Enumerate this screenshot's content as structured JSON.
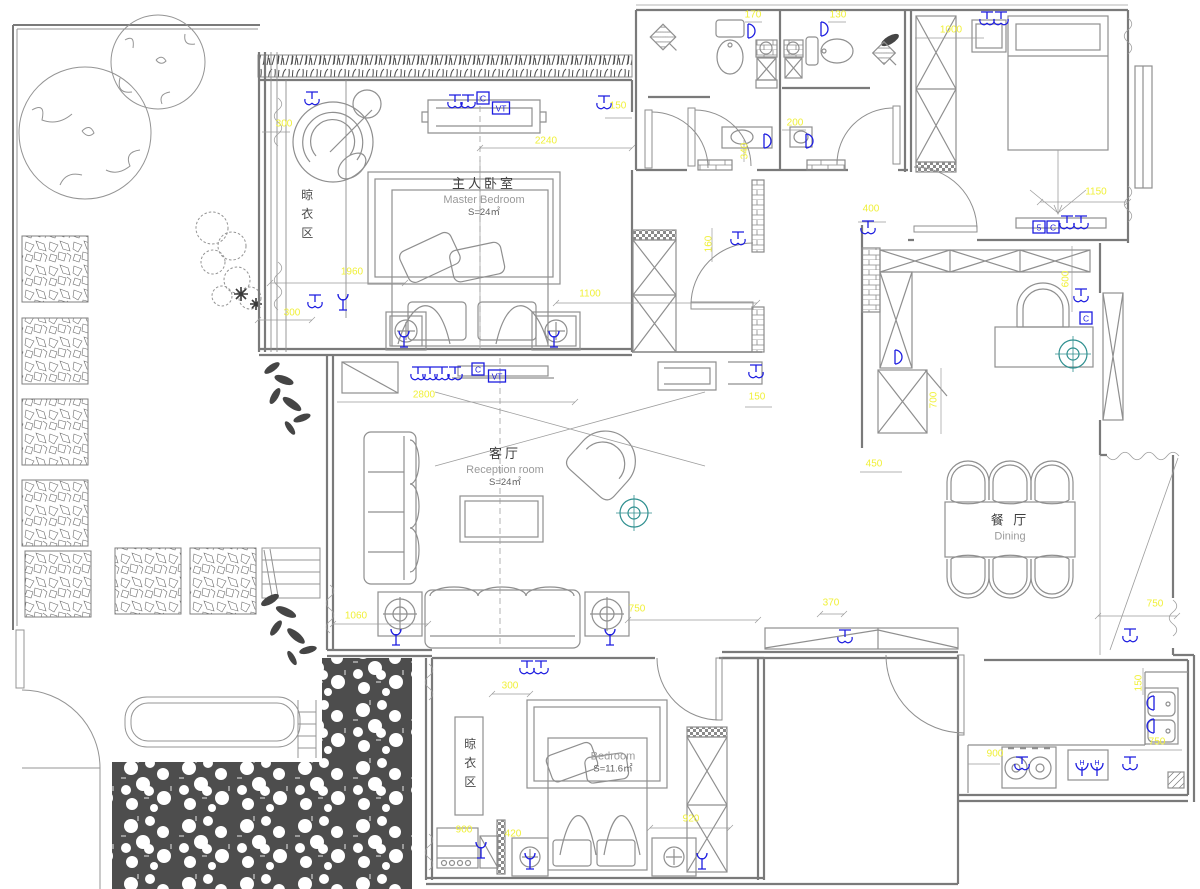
{
  "drawing": {
    "type": "residential floor plan (electrical / furniture layout)",
    "bg": "#ffffff",
    "colors": {
      "walls": "#7a7a7a",
      "furniture": "#8f8f8f",
      "dimension_text": "#f0f038",
      "electrical": "#1d1de0",
      "compass": "#2e8f8f",
      "foliage": "#454545"
    }
  },
  "rooms": [
    {
      "key": "master_bedroom",
      "name_zh": "主人卧室",
      "name_en": "Master Bedroom",
      "area": "S=24㎡"
    },
    {
      "key": "reception_room",
      "name_zh": "客厅",
      "name_en": "Reception  room",
      "area": "S=24㎡"
    },
    {
      "key": "dining_room",
      "name_zh": "餐 厅",
      "name_en": "Dining",
      "area": ""
    },
    {
      "key": "second_bedroom",
      "name_zh": "",
      "name_en": "Bedroom",
      "area": "S=11.6㎡"
    },
    {
      "key": "drying_area_north",
      "name_zh": "晾衣区",
      "name_en": "",
      "area": ""
    },
    {
      "key": "drying_area_south",
      "name_zh": "晾衣区",
      "name_en": "",
      "area": ""
    }
  ],
  "dimensions": [
    {
      "v": "300",
      "x": 284,
      "y": 124
    },
    {
      "v": "1960",
      "x": 352,
      "y": 272
    },
    {
      "v": "300",
      "x": 292,
      "y": 313
    },
    {
      "v": "2240",
      "x": 546,
      "y": 141
    },
    {
      "v": "150",
      "x": 618,
      "y": 106
    },
    {
      "v": "1100",
      "x": 590,
      "y": 294
    },
    {
      "v": "170",
      "x": 753,
      "y": 15
    },
    {
      "v": "130",
      "x": 838,
      "y": 15
    },
    {
      "v": "200",
      "x": 795,
      "y": 123
    },
    {
      "v": "340",
      "x": 745,
      "y": 151,
      "rot": 1
    },
    {
      "v": "1000",
      "x": 951,
      "y": 30
    },
    {
      "v": "1150",
      "x": 1096,
      "y": 192
    },
    {
      "v": "400",
      "x": 871,
      "y": 209
    },
    {
      "v": "160",
      "x": 709,
      "y": 244,
      "rot": 1
    },
    {
      "v": "150",
      "x": 757,
      "y": 397
    },
    {
      "v": "2800",
      "x": 424,
      "y": 395
    },
    {
      "v": "600",
      "x": 1066,
      "y": 279,
      "rot": 1
    },
    {
      "v": "700",
      "x": 934,
      "y": 400,
      "rot": 1
    },
    {
      "v": "450",
      "x": 874,
      "y": 464
    },
    {
      "v": "750",
      "x": 637,
      "y": 609
    },
    {
      "v": "1060",
      "x": 356,
      "y": 616
    },
    {
      "v": "750",
      "x": 1155,
      "y": 604
    },
    {
      "v": "370",
      "x": 831,
      "y": 603
    },
    {
      "v": "300",
      "x": 510,
      "y": 686
    },
    {
      "v": "900",
      "x": 464,
      "y": 830
    },
    {
      "v": "420",
      "x": 513,
      "y": 834
    },
    {
      "v": "920",
      "x": 691,
      "y": 819
    },
    {
      "v": "900",
      "x": 995,
      "y": 754
    },
    {
      "v": "750",
      "x": 1157,
      "y": 742
    },
    {
      "v": "150",
      "x": 1139,
      "y": 683,
      "rot": 1
    }
  ],
  "electrical": [
    {
      "type": "socket",
      "x": 312,
      "y": 100
    },
    {
      "type": "socket",
      "x": 455,
      "y": 103
    },
    {
      "type": "socket",
      "x": 468,
      "y": 103
    },
    {
      "type": "box",
      "label": "C",
      "x": 483,
      "y": 98
    },
    {
      "type": "box",
      "label": "VT",
      "x": 501,
      "y": 108
    },
    {
      "type": "socket",
      "x": 604,
      "y": 104
    },
    {
      "type": "socket",
      "x": 315,
      "y": 303
    },
    {
      "type": "lamp",
      "x": 343,
      "y": 303
    },
    {
      "type": "lamp",
      "x": 404,
      "y": 340
    },
    {
      "type": "lamp",
      "x": 554,
      "y": 340
    },
    {
      "type": "socket",
      "x": 738,
      "y": 240
    },
    {
      "type": "socket",
      "x": 418,
      "y": 375
    },
    {
      "type": "socket",
      "x": 430,
      "y": 375
    },
    {
      "type": "socket",
      "x": 442,
      "y": 375
    },
    {
      "type": "socket",
      "x": 455,
      "y": 375
    },
    {
      "type": "box",
      "label": "C",
      "x": 478,
      "y": 369
    },
    {
      "type": "box",
      "label": "VT",
      "x": 497,
      "y": 376
    },
    {
      "type": "socket",
      "x": 756,
      "y": 373
    },
    {
      "type": "socket",
      "x": 868,
      "y": 229
    },
    {
      "type": "arc",
      "x": 748,
      "y": 31
    },
    {
      "type": "arc",
      "x": 821,
      "y": 29
    },
    {
      "type": "arc",
      "x": 764,
      "y": 141
    },
    {
      "type": "arc",
      "x": 806,
      "y": 141
    },
    {
      "type": "arc",
      "x": 895,
      "y": 357
    },
    {
      "type": "socket",
      "x": 987,
      "y": 20
    },
    {
      "type": "socket",
      "x": 1001,
      "y": 20
    },
    {
      "type": "box",
      "label": "5",
      "x": 1039,
      "y": 227
    },
    {
      "type": "box",
      "label": "C",
      "x": 1053,
      "y": 227
    },
    {
      "type": "socket",
      "x": 1067,
      "y": 224
    },
    {
      "type": "socket",
      "x": 1081,
      "y": 224
    },
    {
      "type": "socket",
      "x": 1081,
      "y": 297
    },
    {
      "type": "box",
      "label": "C",
      "x": 1086,
      "y": 318
    },
    {
      "type": "lamp",
      "x": 396,
      "y": 638
    },
    {
      "type": "lamp",
      "x": 610,
      "y": 638
    },
    {
      "type": "socket",
      "x": 527,
      "y": 669
    },
    {
      "type": "socket",
      "x": 541,
      "y": 669
    },
    {
      "type": "socket",
      "x": 845,
      "y": 638
    },
    {
      "type": "socket",
      "x": 1130,
      "y": 637
    },
    {
      "type": "lamp",
      "x": 481,
      "y": 851
    },
    {
      "type": "lamp",
      "x": 530,
      "y": 862
    },
    {
      "type": "lamp",
      "x": 702,
      "y": 862
    },
    {
      "type": "socket",
      "x": 1022,
      "y": 765
    },
    {
      "type": "sockH",
      "label": "H",
      "x": 1082,
      "y": 766
    },
    {
      "type": "sockH",
      "label": "H",
      "x": 1097,
      "y": 766
    },
    {
      "type": "socket",
      "x": 1130,
      "y": 765
    },
    {
      "type": "arc",
      "x": 1154,
      "y": 703,
      "rot": 180
    },
    {
      "type": "arc",
      "x": 1154,
      "y": 726,
      "rot": 180
    }
  ],
  "compass": [
    {
      "x": 634,
      "y": 513
    },
    {
      "x": 1073,
      "y": 354
    }
  ]
}
